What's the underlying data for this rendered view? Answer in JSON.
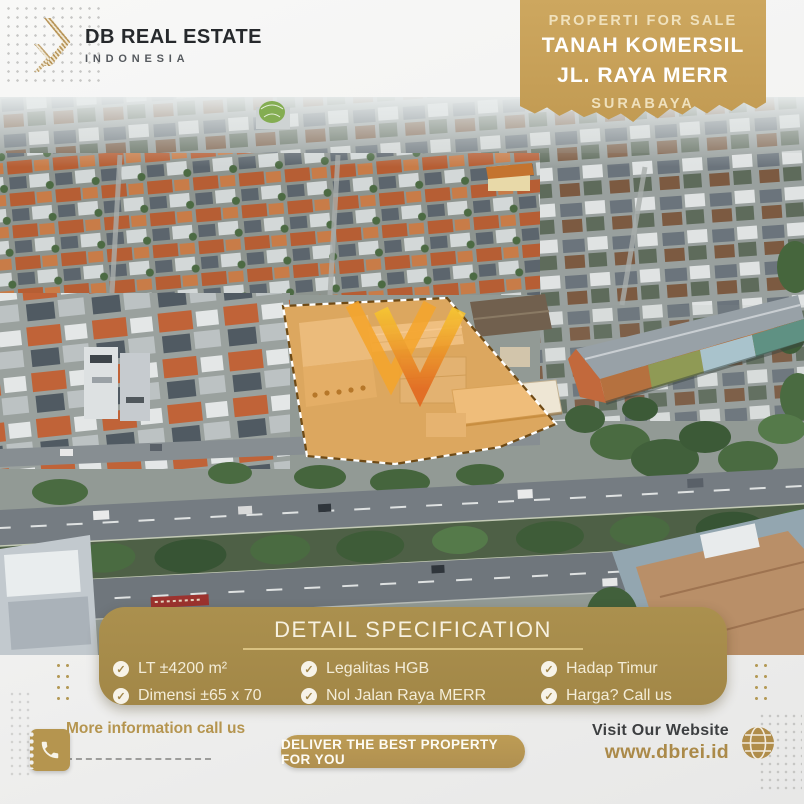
{
  "brand": {
    "name": "DB REAL ESTATE",
    "subtitle": "INDONESIA"
  },
  "ribbon": {
    "tagline": "PROPERTI FOR SALE",
    "title_line1": "TANAH KOMERSIL",
    "title_line2": "JL. RAYA MERR",
    "location": "SURABAYA"
  },
  "specification": {
    "title": "DETAIL SPECIFICATION",
    "items": [
      {
        "label": "LT ±4200 m²"
      },
      {
        "label": "Dimensi ±65 x 70"
      },
      {
        "label": "Legalitas HGB"
      },
      {
        "label": "Nol Jalan Raya MERR"
      },
      {
        "label": "Hadap Timur"
      },
      {
        "label": "Harga? Call us"
      }
    ]
  },
  "footer": {
    "contact_label": "More information call us",
    "slogan": "DELIVER THE BEST PROPERTY FOR YOU",
    "website_label": "Visit Our Website",
    "website_url": "www.dbrei.id"
  },
  "icons": {
    "check_glyph": "✓",
    "logo": "double-chevron-right",
    "phone": "phone-receiver",
    "globe": "globe-grid",
    "watermark": "double-chevron-v"
  },
  "colors": {
    "ribbon_gold": "#c7a15c",
    "panel_gold": "#a98e4d",
    "button_gold": "#b79750",
    "accent_text_gold": "#ab8a49",
    "lot_highlight": "#e08b2d",
    "dark_text": "#26292c"
  }
}
